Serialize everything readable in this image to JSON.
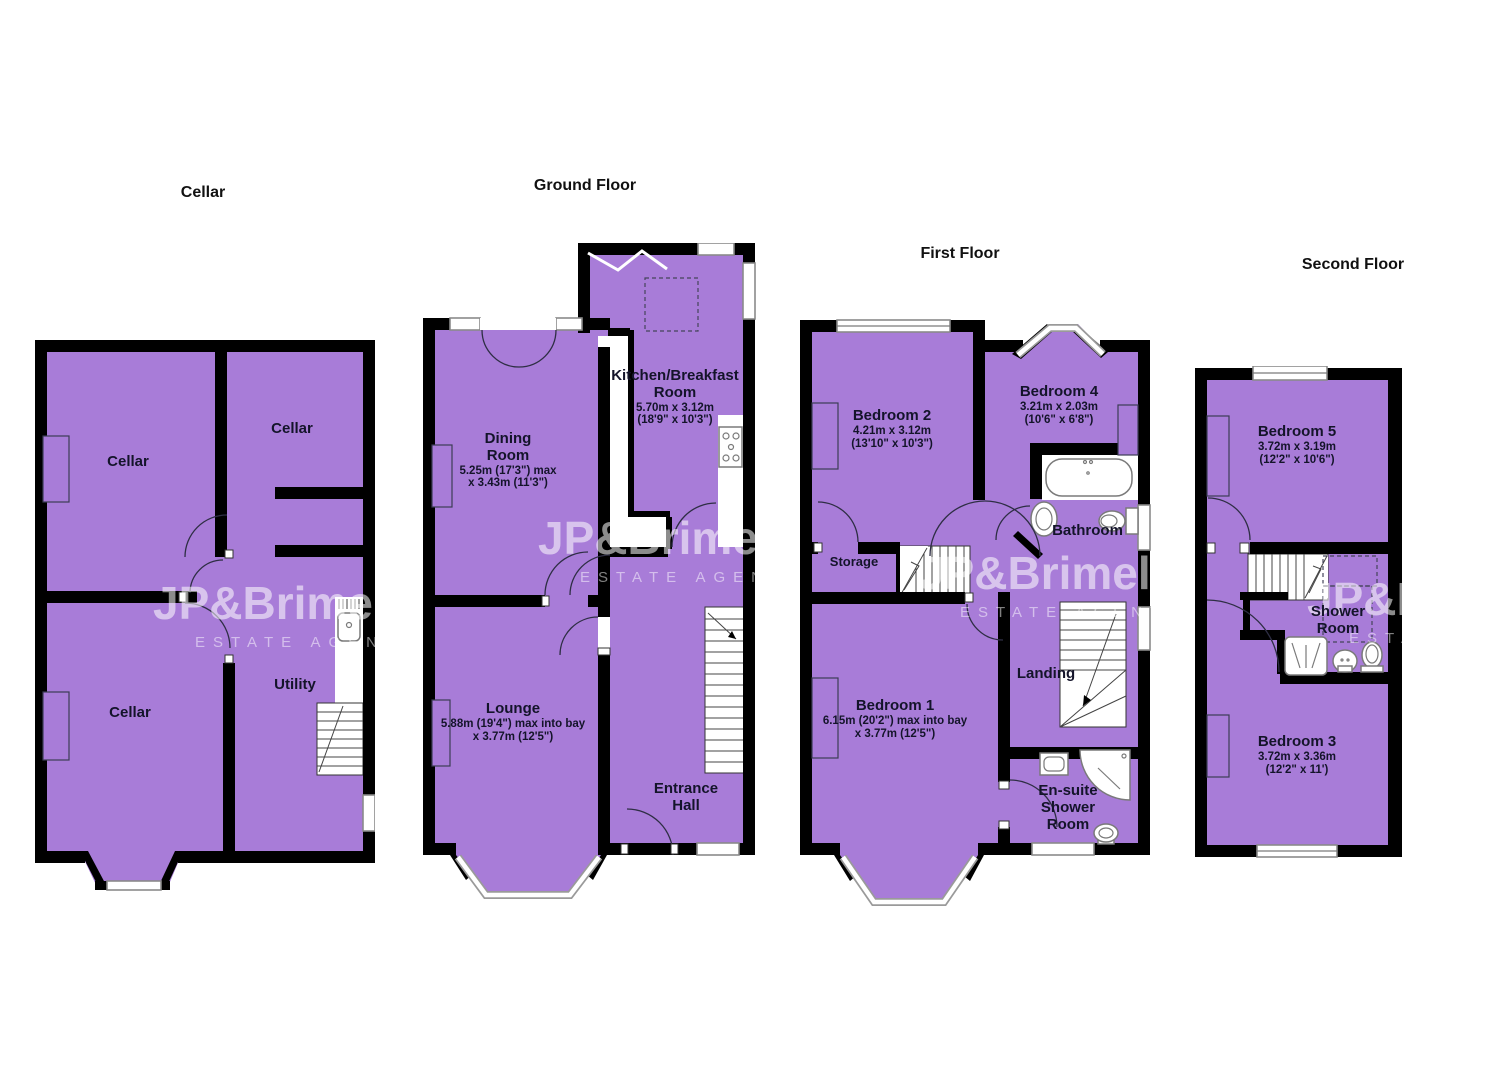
{
  "colors": {
    "room_fill": "#a87cd8",
    "wall": "#000000",
    "background": "#ffffff",
    "label_text": "#14142a"
  },
  "watermark": {
    "brand": "JP&Brimelow",
    "sub": "ESTATE AGENTS"
  },
  "floors": [
    {
      "title": "Cellar",
      "rooms": [
        {
          "name": "Cellar"
        },
        {
          "name": "Cellar"
        },
        {
          "name": "Cellar"
        },
        {
          "name": "Utility"
        }
      ]
    },
    {
      "title": "Ground Floor",
      "rooms": [
        {
          "name": "Kitchen/Breakfast Room",
          "dim_metric": "5.70m x 3.12m",
          "dim_imperial": "(18'9\" x 10'3\")"
        },
        {
          "name": "Dining Room",
          "dim_metric": "5.25m (17'3\") max",
          "dim_imperial": "x 3.43m (11'3\")"
        },
        {
          "name": "Lounge",
          "dim_metric": "5.88m (19'4\") max into bay",
          "dim_imperial": "x 3.77m (12'5\")"
        },
        {
          "name": "Entrance Hall"
        }
      ]
    },
    {
      "title": "First Floor",
      "rooms": [
        {
          "name": "Bedroom 2",
          "dim_metric": "4.21m x 3.12m",
          "dim_imperial": "(13'10\" x 10'3\")"
        },
        {
          "name": "Bedroom 4",
          "dim_metric": "3.21m x 2.03m",
          "dim_imperial": "(10'6\" x 6'8\")"
        },
        {
          "name": "Bathroom"
        },
        {
          "name": "Storage"
        },
        {
          "name": "Landing"
        },
        {
          "name": "Bedroom 1",
          "dim_metric": "6.15m (20'2\") max into bay",
          "dim_imperial": "x 3.77m (12'5\")"
        },
        {
          "name": "En-suite Shower Room"
        }
      ]
    },
    {
      "title": "Second Floor",
      "rooms": [
        {
          "name": "Bedroom 5",
          "dim_metric": "3.72m x 3.19m",
          "dim_imperial": "(12'2\" x 10'6\")"
        },
        {
          "name": "Shower Room"
        },
        {
          "name": "Bedroom 3",
          "dim_metric": "3.72m x 3.36m",
          "dim_imperial": "(12'2\" x 11')"
        }
      ]
    }
  ]
}
